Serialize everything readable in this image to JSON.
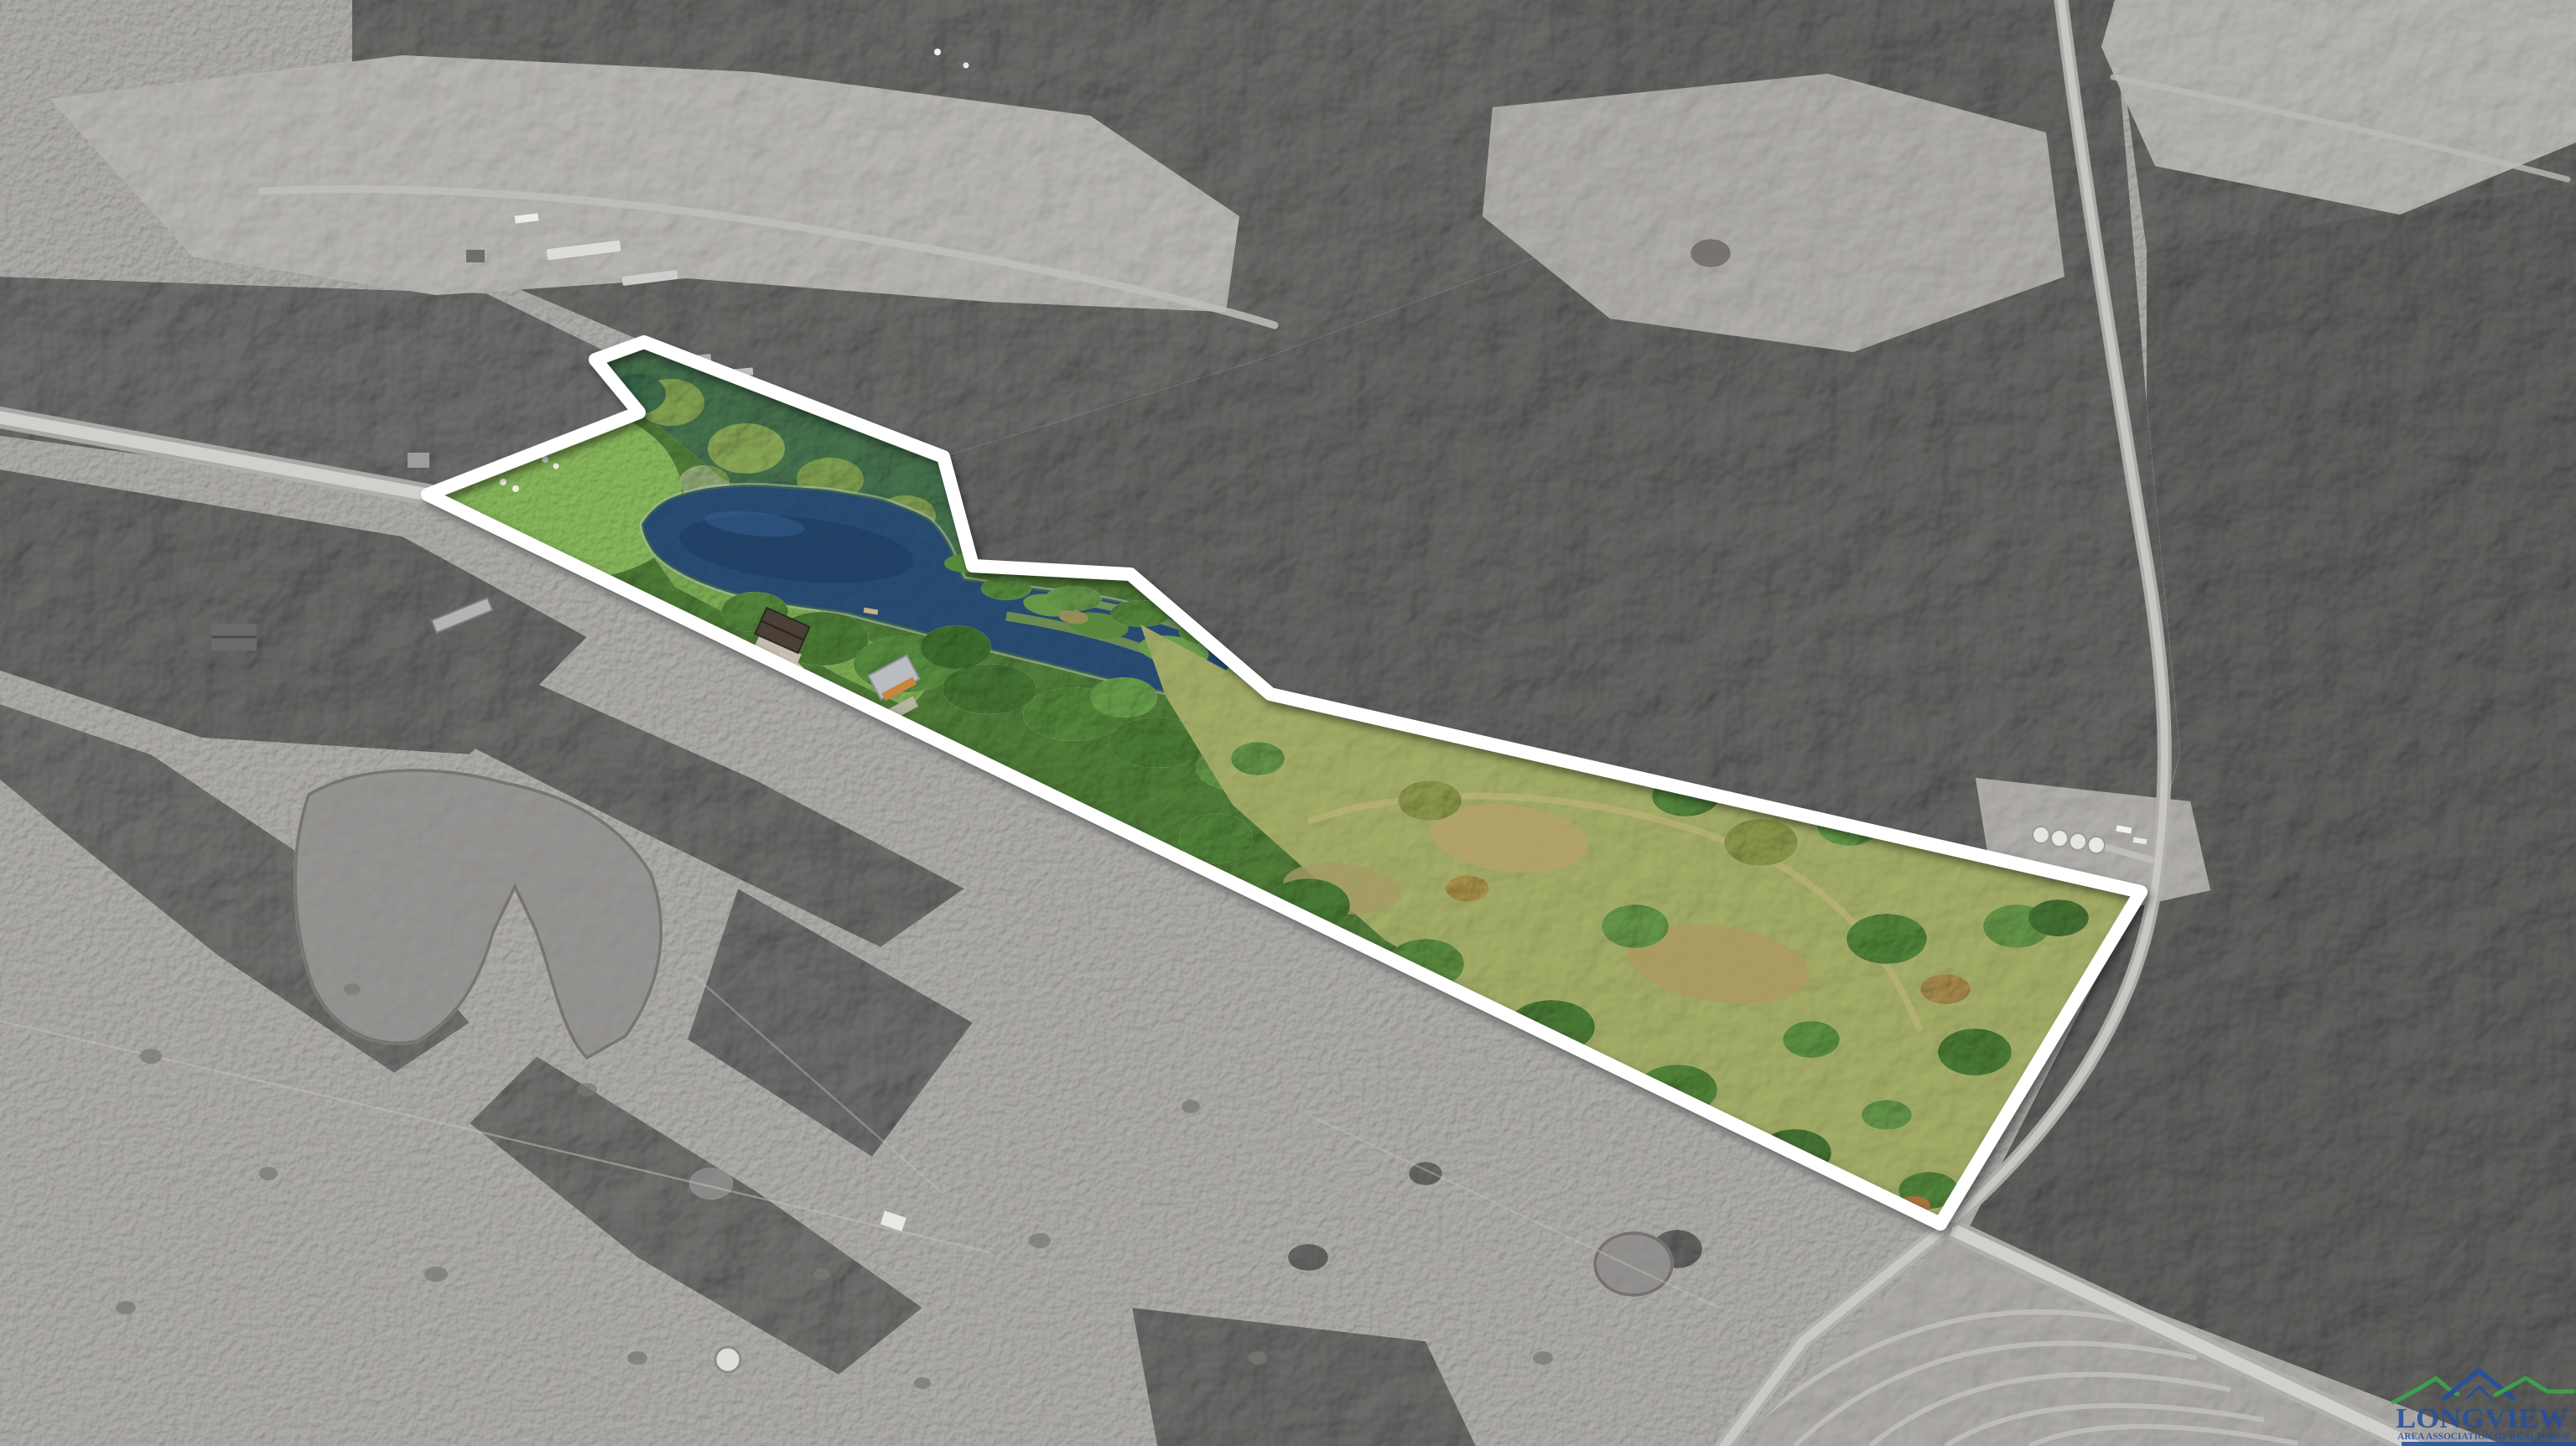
{
  "scene": {
    "kind": "aerial-drone-photograph",
    "treatment": "listed land parcel shown in color with white boundary outline; surrounding countryside desaturated to grayscale",
    "landmarks": [
      "white outlined property parcel",
      "large pond and wetland inside parcel",
      "mowed lawn at west corner",
      "house and cabin with driveway along road",
      "country road along the south boundary",
      "road junction at the southeast corner",
      "grain silos clearing east of parcel",
      "farmstead with long barns northwest",
      "stock ponds in the south pasture",
      "plowed field in the bottom right corner",
      "dense surrounding forest"
    ]
  },
  "watermark": {
    "brand": "LONGVIEW",
    "tagline": "AREA ASSOCIATION OF REALTORS®"
  },
  "palette": {
    "boundary_outline": "#ffffff",
    "brand_blue": "#24509e",
    "brand_green": "#3aa94c",
    "pond_water": "#1e3c62",
    "parcel_grass": "#7cab51",
    "parcel_forest": "#47722e",
    "meadow_olive": "#95a15c",
    "grayscale_field": "#a9a9a9",
    "grayscale_forest": "#565656",
    "road_gray": "#cfcfcf"
  }
}
